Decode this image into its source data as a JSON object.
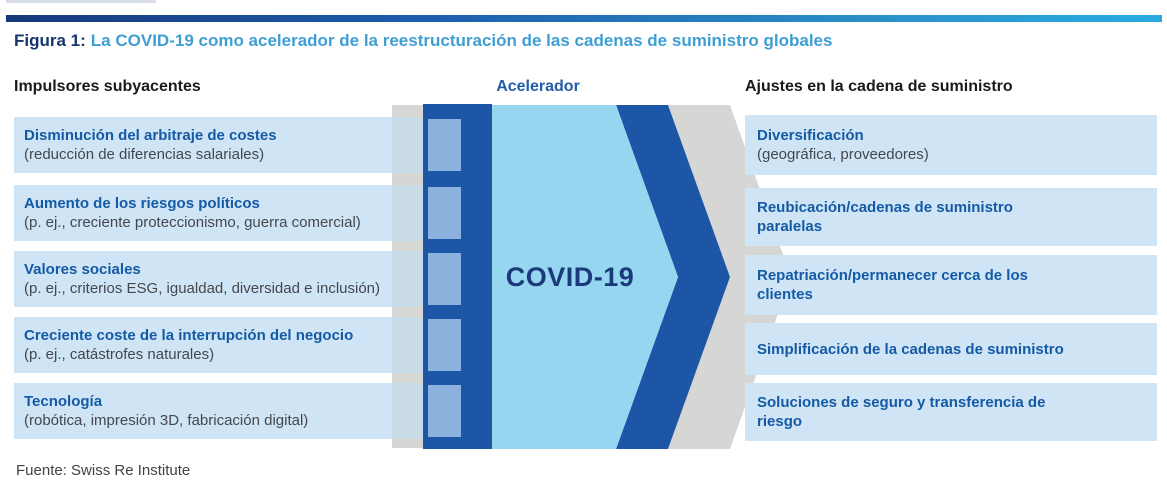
{
  "title": {
    "label": "Figura 1:",
    "text": "La COVID-19 como acelerador de la reestructuración de las cadenas de suministro globales"
  },
  "headers": {
    "left": "Impulsores subyacentes",
    "center": "Acelerador",
    "right": "Ajustes en la cadena de suministro"
  },
  "accelerator": {
    "label": "COVID-19"
  },
  "drivers": [
    {
      "title": "Disminución del arbitraje de costes",
      "subtitle": "(reducción de diferencias salariales)"
    },
    {
      "title": "Aumento de los riesgos políticos",
      "subtitle": "(p. ej., creciente proteccionismo, guerra comercial)"
    },
    {
      "title": "Valores sociales",
      "subtitle": "(p. ej., criterios ESG, igualdad, diversidad e inclusión)"
    },
    {
      "title": "Creciente coste de la interrupción del negocio",
      "subtitle": "(p. ej., catástrofes naturales)"
    },
    {
      "title": "Tecnología",
      "subtitle": "(robótica, impresión 3D, fabricación digital)"
    }
  ],
  "adjustments": [
    {
      "title": "Diversificación",
      "subtitle": "(geográfica, proveedores)"
    },
    {
      "title": "Reubicación/cadenas de suministro\nparalelas"
    },
    {
      "title": "Repatriación/permanecer cerca de los\nclientes"
    },
    {
      "title": "Simplificación de la cadenas de suministro"
    },
    {
      "title": "Soluciones de seguro y transferencia de\nriesgo"
    }
  ],
  "footer": {
    "source": "Fuente: Swiss Re Institute"
  },
  "colors": {
    "gradient_bar_left": "#16387c",
    "gradient_bar_right": "#29abe2",
    "title_label": "#16356e",
    "title_accent": "#3f9fd4",
    "box_fill": "#cfe5f6",
    "box_title_blue": "#155aa5",
    "box_subtitle_gray": "#44484e",
    "navy": "#1d56a7",
    "cyan_arrow": "#97d6f1",
    "gray_band": "#d6d6d4",
    "step_blue": "#cadbe8",
    "square_blue": "#8ab2dc",
    "covid_text": "#1b3a7a"
  }
}
